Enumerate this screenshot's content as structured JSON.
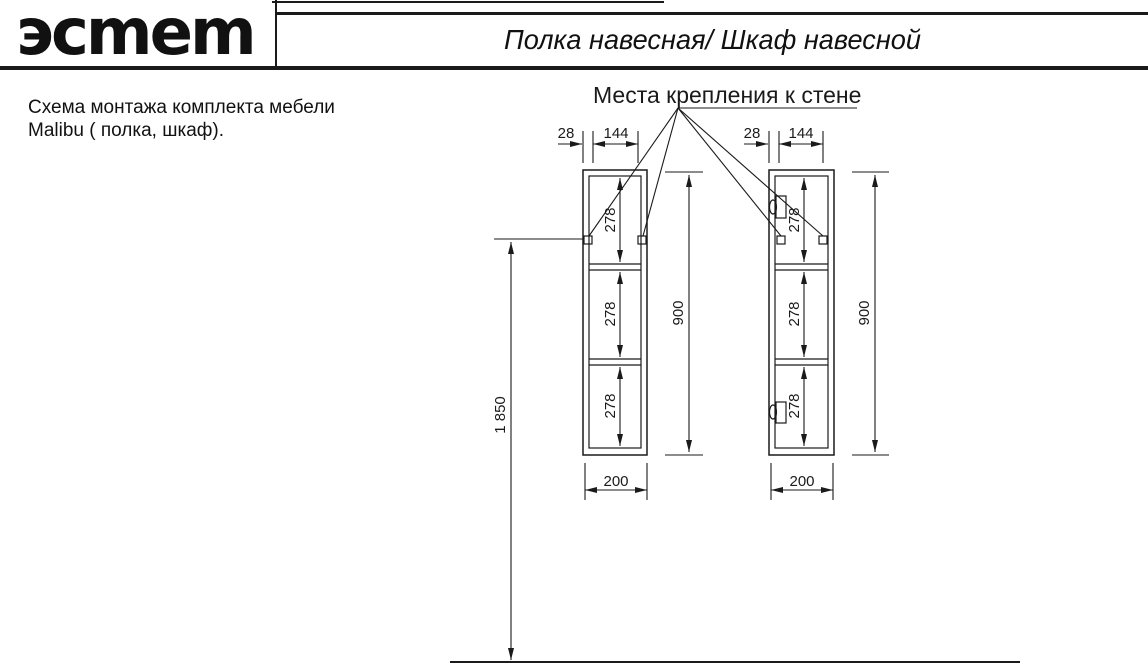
{
  "header": {
    "logo": "эсmem",
    "title": "Полка навесная/ Шкаф навесной"
  },
  "description": {
    "line1": "Схема монтажа комплекта мебели",
    "line2": "Malibu ( полка, шкаф)."
  },
  "drawing": {
    "callout_title": "Места крепления к стене",
    "dims": {
      "edge_offset": "28",
      "hole_spacing": "144",
      "section_heights": [
        "278",
        "278",
        "278"
      ],
      "unit_height": "900",
      "unit_width": "200",
      "mount_height": "1 850"
    },
    "line_color": "#1a1a1a"
  }
}
